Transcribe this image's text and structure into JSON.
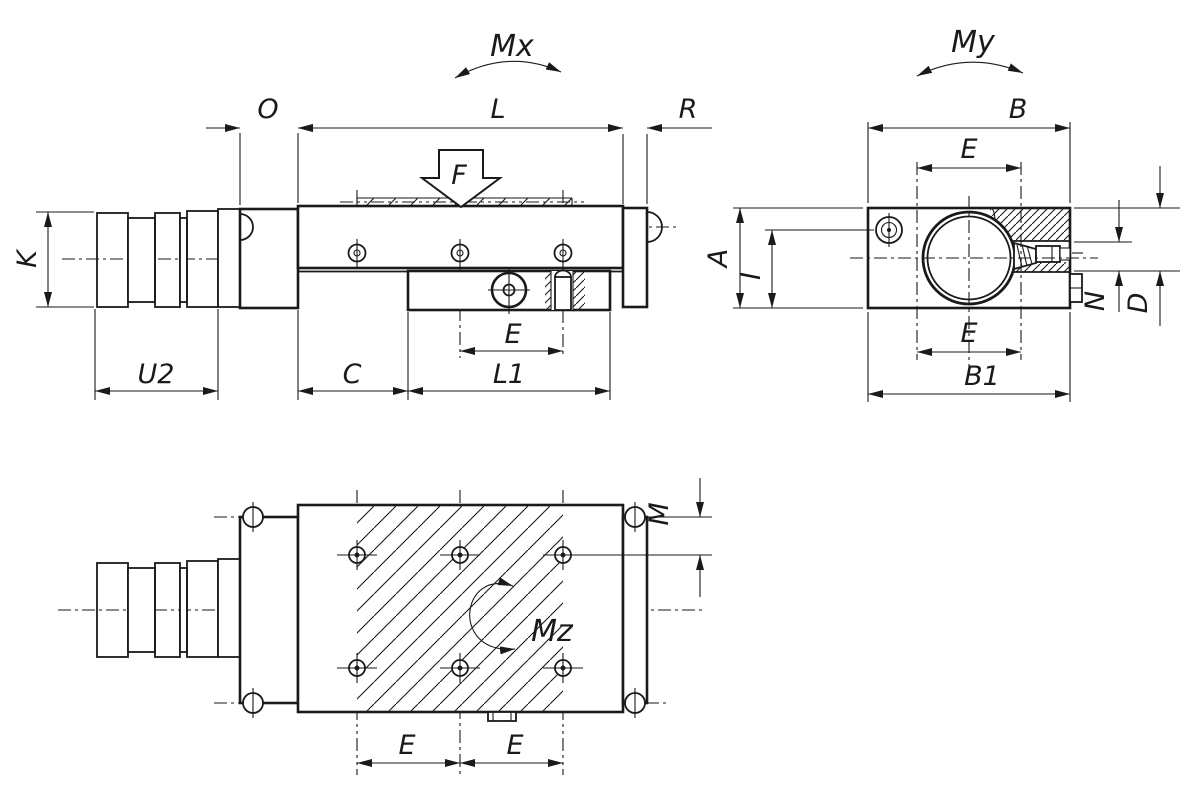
{
  "labels": {
    "side": {
      "moment": "Mx",
      "force": "F",
      "O": "O",
      "L": "L",
      "R": "R",
      "K": "K",
      "U2": "U2",
      "C": "C",
      "E": "E",
      "L1": "L1"
    },
    "end": {
      "moment": "My",
      "B": "B",
      "E_top": "E",
      "A": "A",
      "I": "I",
      "E_bottom": "E",
      "B1": "B1",
      "N": "N",
      "D": "D"
    },
    "top": {
      "moment": "Mz",
      "M": "M",
      "E_left": "E",
      "E_right": "E"
    }
  },
  "colors": {
    "line": "#1a1a1a",
    "background": "#ffffff"
  }
}
